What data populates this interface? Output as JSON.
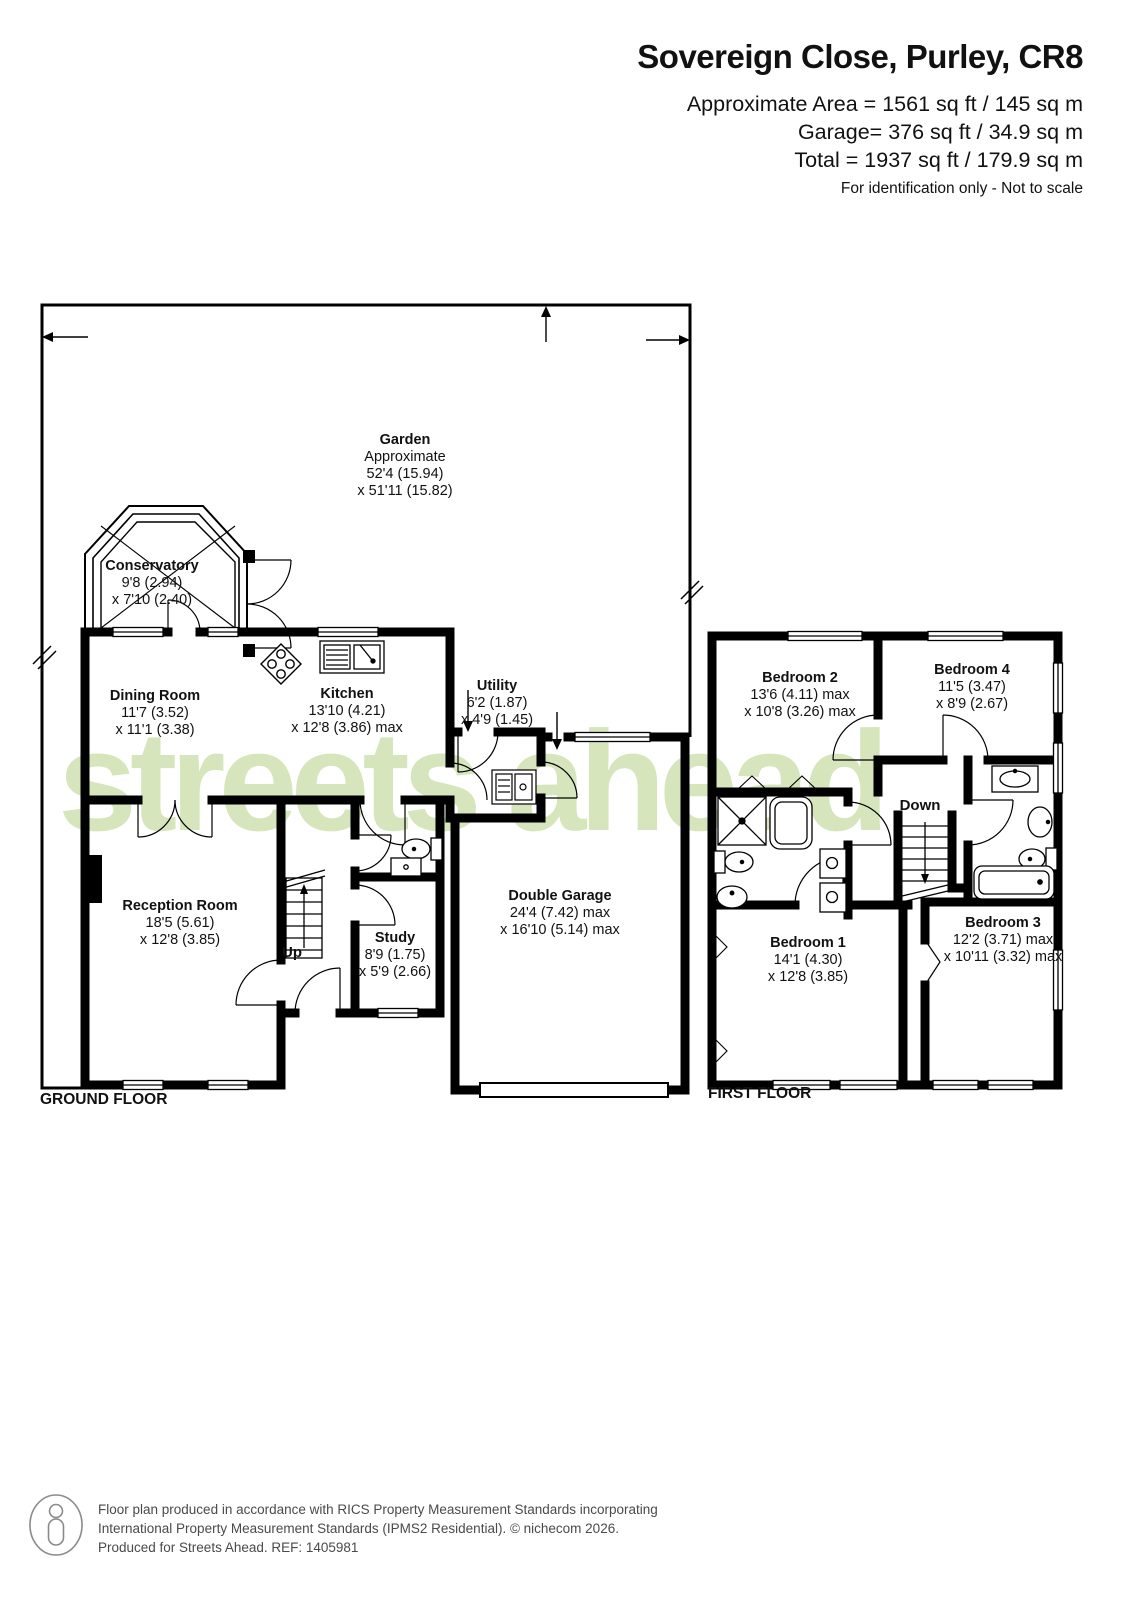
{
  "header": {
    "title": "Sovereign Close, Purley, CR8",
    "area_lines": [
      "Approximate Area = 1561 sq ft / 145 sq m",
      "Garage= 376 sq ft / 34.9 sq m",
      "Total = 1937 sq ft / 179.9 sq m"
    ],
    "note": "For identification only - Not to scale"
  },
  "ground_floor": {
    "label": "GROUND FLOOR",
    "garden": {
      "name": "Garden",
      "l1": "Approximate",
      "l2": "52'4 (15.94)",
      "l3": "x 51'11 (15.82)"
    },
    "conservatory": {
      "name": "Conservatory",
      "l1": "9'8 (2.94)",
      "l2": "x 7'10 (2.40)"
    },
    "dining_room": {
      "name": "Dining Room",
      "l1": "11'7 (3.52)",
      "l2": "x 11'1 (3.38)"
    },
    "kitchen": {
      "name": "Kitchen",
      "l1": "13'10 (4.21)",
      "l2": "x 12'8 (3.86) max"
    },
    "utility": {
      "name": "Utility",
      "l1": "6'2 (1.87)",
      "l2": "x 4'9 (1.45)"
    },
    "reception_room": {
      "name": "Reception Room",
      "l1": "18'5 (5.61)",
      "l2": "x 12'8 (3.85)"
    },
    "study": {
      "name": "Study",
      "l1": "8'9 (1.75)",
      "l2": "x 5'9 (2.66)"
    },
    "double_garage": {
      "name": "Double Garage",
      "l1": "24'4 (7.42) max",
      "l2": "x 16'10 (5.14) max"
    },
    "stairs": "Up"
  },
  "first_floor": {
    "label": "FIRST FLOOR",
    "bedroom1": {
      "name": "Bedroom 1",
      "l1": "14'1 (4.30)",
      "l2": "x 12'8 (3.85)"
    },
    "bedroom2": {
      "name": "Bedroom 2",
      "l1": "13'6 (4.11) max",
      "l2": "x 10'8 (3.26) max"
    },
    "bedroom3": {
      "name": "Bedroom 3",
      "l1": "12'2 (3.71) max",
      "l2": "x 10'11 (3.32) max"
    },
    "bedroom4": {
      "name": "Bedroom 4",
      "l1": "11'5 (3.47)",
      "l2": "x 8'9 (2.67)"
    },
    "stairs": "Down"
  },
  "watermark": "streets ahead",
  "footer": {
    "line1": "Floor plan produced in accordance with RICS Property Measurement Standards incorporating",
    "line2": "International Property Measurement Standards (IPMS2 Residential).   © nichecom 2026.",
    "line3": "Produced for Streets Ahead.   REF:  1405981"
  },
  "colors": {
    "wall": "#000000",
    "watermark": "#d6e5bc",
    "footer_text": "#4a4a4a"
  }
}
